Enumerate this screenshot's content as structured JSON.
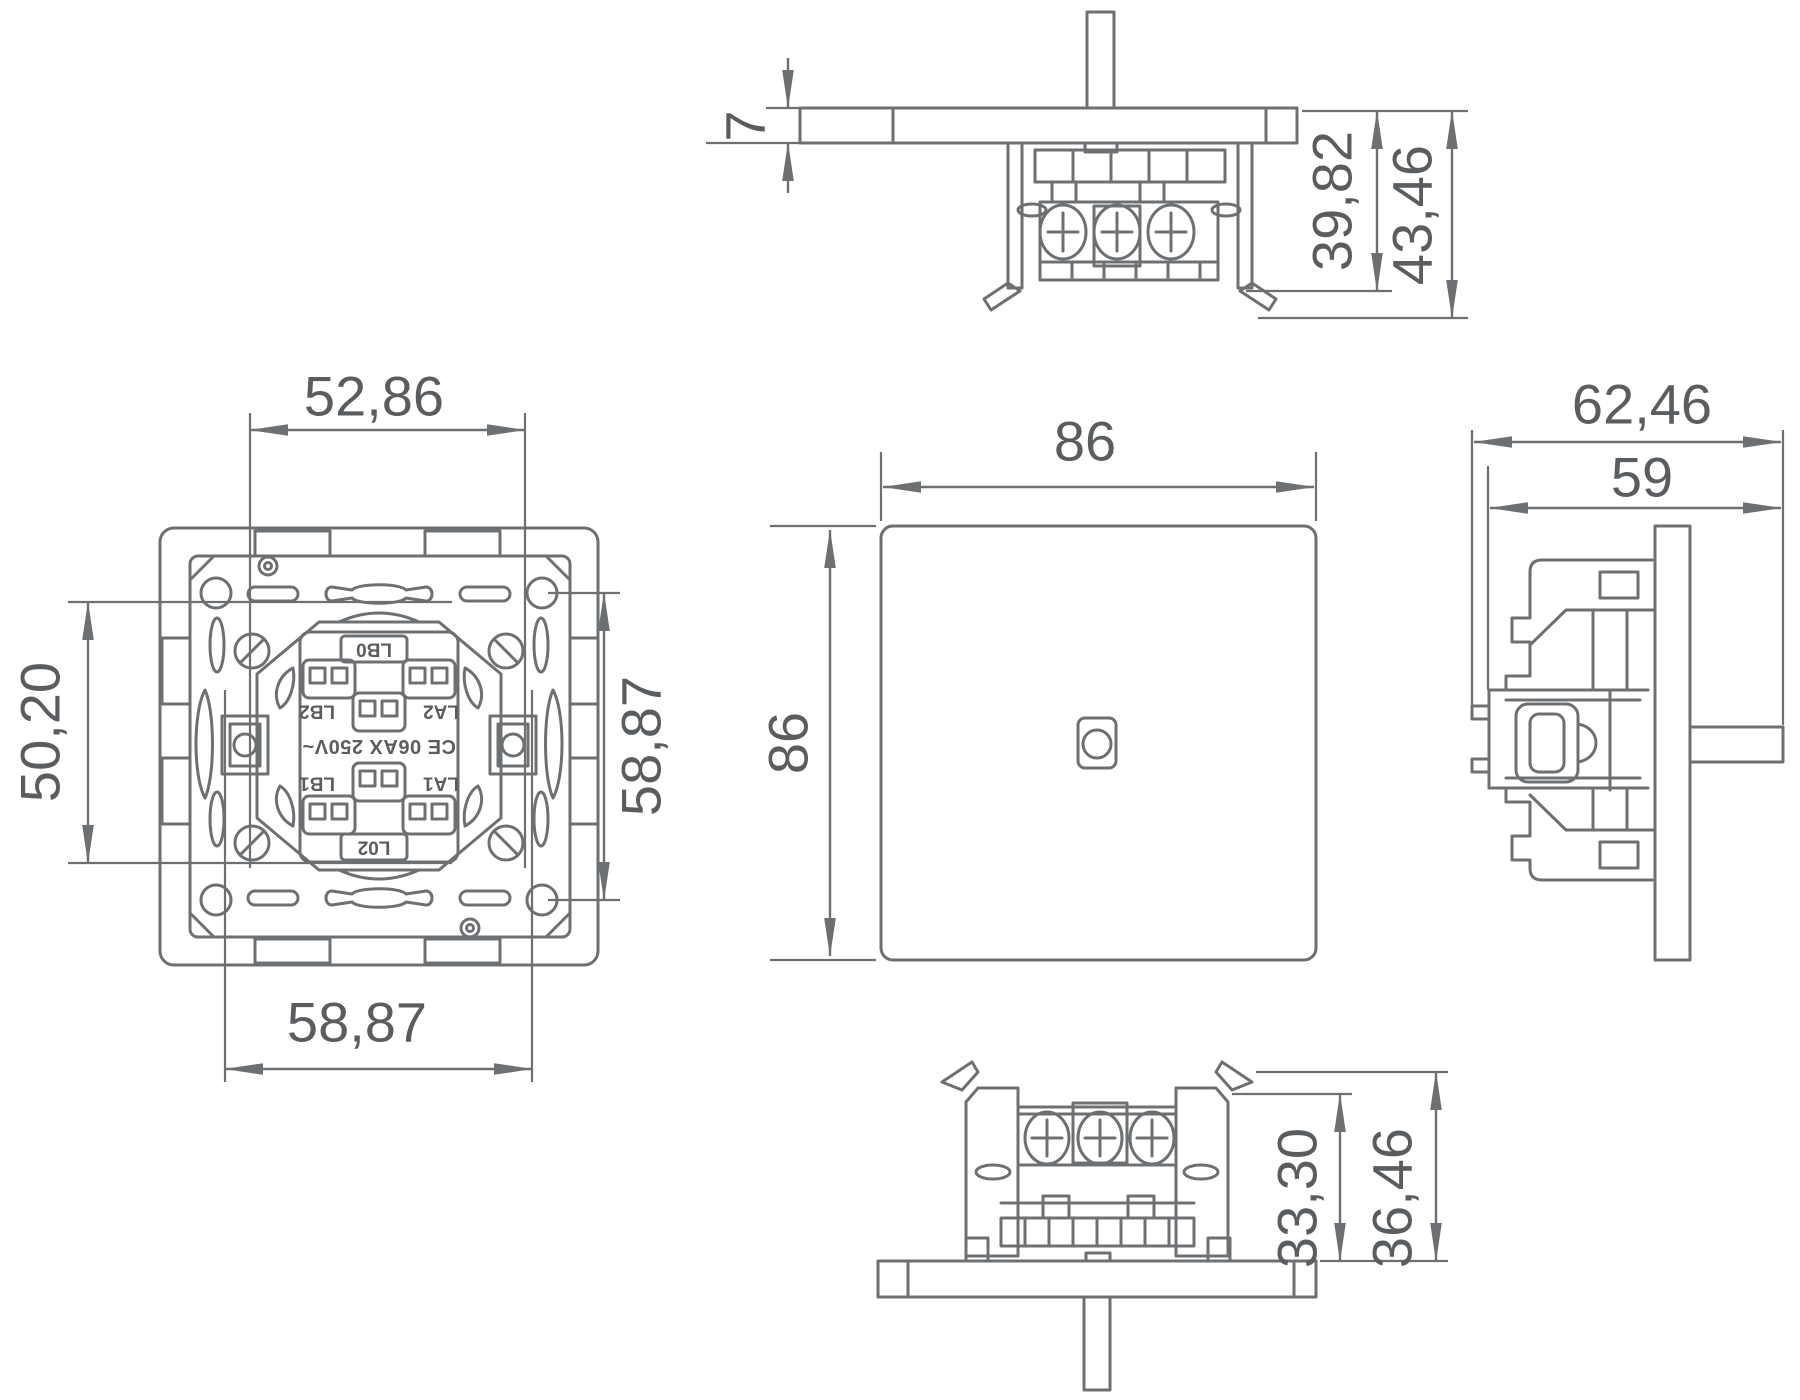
{
  "drawing_type": "dimensioned technical drawing of a wall light switch, five orthographic views",
  "colors": {
    "line": "#6d7073",
    "text": "#5a5d60",
    "background": "#ffffff"
  },
  "views": {
    "top": {
      "title": "top profile view",
      "dims": {
        "plate_thickness": "7",
        "depth_to_claw": "39,82",
        "depth_total": "43,46"
      }
    },
    "back": {
      "title": "rear view of mechanism",
      "dims": {
        "width_top": "52,86",
        "height_left": "50,20",
        "height_right": "58,87",
        "width_bottom": "58,87"
      },
      "labels": {
        "terminal_top": "LB0",
        "terminal_mid_left": "LB2",
        "terminal_mid_right": "LA2",
        "rating": "CE 06AX 250V~",
        "terminal_low_left": "LB1",
        "terminal_low_right": "LA1",
        "terminal_bottom": "L02"
      }
    },
    "front": {
      "title": "front face view",
      "dims": {
        "width": "86",
        "height": "86"
      }
    },
    "side": {
      "title": "side profile view",
      "dims": {
        "depth_with_claws": "62,46",
        "depth_body": "59"
      }
    },
    "bottom": {
      "title": "bottom profile view",
      "dims": {
        "height_body": "33,30",
        "height_total": "36,46"
      }
    }
  }
}
